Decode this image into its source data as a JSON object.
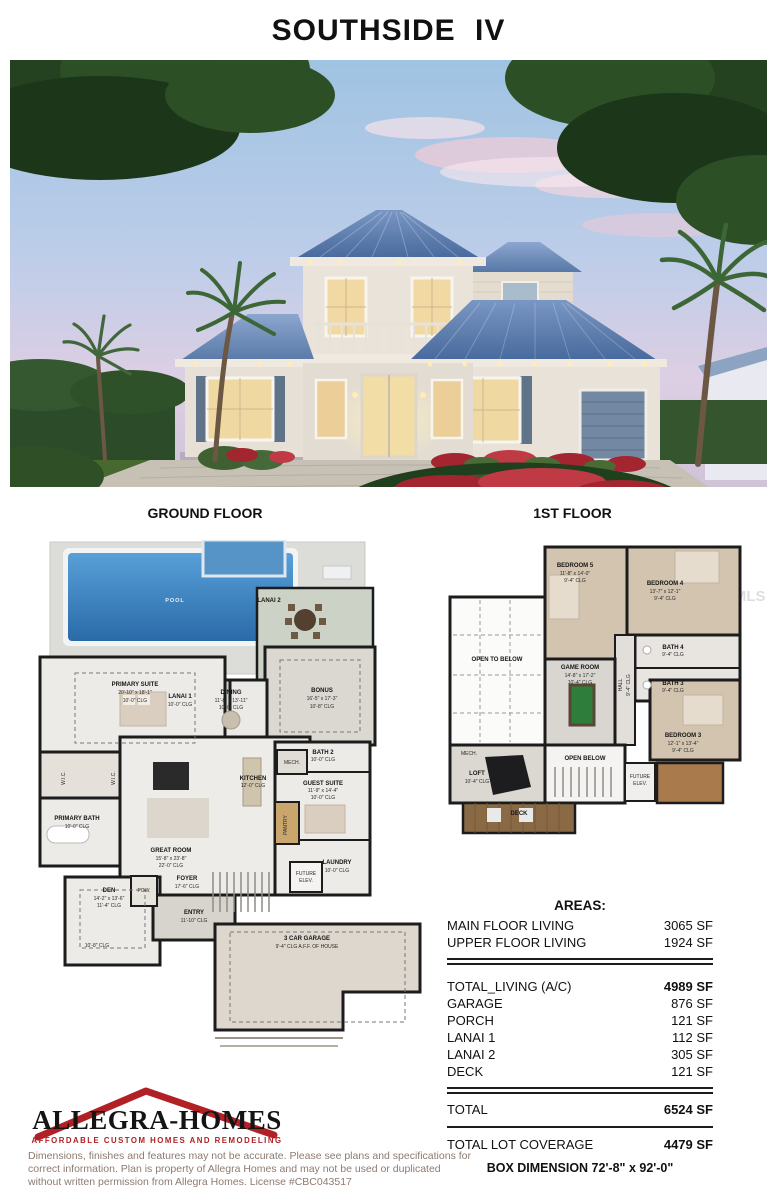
{
  "page": {
    "title": "SOUTHSIDE IV"
  },
  "floor_plans": {
    "ground": {
      "heading": "GROUND FLOOR",
      "rooms": [
        {
          "lines": [
            "POOL"
          ]
        },
        {
          "lines": [
            "LANAI 2"
          ]
        },
        {
          "lines": [
            "PRIMARY SUITE",
            "20'-10\" x 18'-1\"",
            "10'-0\" CLG"
          ]
        },
        {
          "lines": [
            "LANAI 1",
            "10'-0\" CLG"
          ]
        },
        {
          "lines": [
            "DINING",
            "11'-8\" x 13'-11\"",
            "10'-0\" CLG"
          ]
        },
        {
          "lines": [
            "BONUS",
            "16'-5\" x 17'-3\"",
            "10'-8\" CLG"
          ]
        },
        {
          "lines": [
            "BATH 2",
            "10'-0\" CLG"
          ]
        },
        {
          "lines": [
            "GUEST SUITE",
            "11'-9\" x 14'-4\"",
            "10'-0\" CLG"
          ]
        },
        {
          "lines": [
            "KITCHEN",
            "12'-0\" CLG"
          ]
        },
        {
          "lines": [
            "MECH."
          ]
        },
        {
          "lines": [
            "PANTRY"
          ]
        },
        {
          "lines": [
            "W.I.C."
          ]
        },
        {
          "lines": [
            "W.I.C."
          ]
        },
        {
          "lines": [
            "GREAT ROOM",
            "15'-8\" x 23'-8\"",
            "22'-0\" CLG"
          ]
        },
        {
          "lines": [
            "PRIMARY BATH",
            "10'-0\" CLG"
          ]
        },
        {
          "lines": [
            "FOYER",
            "17'-6\" CLG"
          ]
        },
        {
          "lines": [
            "POW."
          ]
        },
        {
          "lines": [
            "DEN",
            "14'-2\" x 13'-6\"",
            "11'-4\" CLG"
          ]
        },
        {
          "lines": [
            "10'-8\" CLG"
          ]
        },
        {
          "lines": [
            "LAUNDRY",
            "10'-0\" CLG"
          ]
        },
        {
          "lines": [
            "FUTURE",
            "ELEV."
          ]
        },
        {
          "lines": [
            "ENTRY",
            "11'-10\" CLG"
          ]
        },
        {
          "lines": [
            "3 CAR GARAGE",
            "9'-4\" CLG A.F.F. OF HOUSE"
          ]
        }
      ]
    },
    "first": {
      "heading": "1ST FLOOR",
      "rooms": [
        {
          "lines": [
            "BEDROOM 5",
            "11'-8\" x 14'-0\"",
            "9'-4\" CLG"
          ]
        },
        {
          "lines": [
            "BEDROOM 4",
            "13'-7\" x 12'-1\"",
            "9'-4\" CLG"
          ]
        },
        {
          "lines": [
            "BATH 4",
            "9'-4\" CLG"
          ]
        },
        {
          "lines": [
            "BATH 3",
            "9'-4\" CLG"
          ]
        },
        {
          "lines": [
            "GAME ROOM",
            "14'-8\" x 17'-2\"",
            "10'-4\" CLG"
          ]
        },
        {
          "lines": [
            "HALL",
            "9'-4\" CLG"
          ]
        },
        {
          "lines": [
            "OPEN TO BELOW"
          ]
        },
        {
          "lines": [
            "BEDROOM 3",
            "12'-1\" x 13'-4\"",
            "9'-4\" CLG"
          ]
        },
        {
          "lines": [
            "MECH."
          ]
        },
        {
          "lines": [
            "LOFT",
            "10'-4\" CLG"
          ]
        },
        {
          "lines": [
            "OPEN BELOW"
          ]
        },
        {
          "lines": [
            "FUTURE",
            "ELEV."
          ]
        },
        {
          "lines": [
            "DECK"
          ]
        }
      ]
    }
  },
  "watermark": "StellarMLS",
  "areas": {
    "heading": "AREAS:",
    "main_rows": [
      {
        "label": "MAIN FLOOR LIVING",
        "value": "3065 SF"
      },
      {
        "label": "UPPER FLOOR LIVING",
        "value": "1924 SF"
      }
    ],
    "detail_rows": [
      {
        "label": "TOTAL_LIVING (A/C)",
        "value": "4989 SF"
      },
      {
        "label": "GARAGE",
        "value": "876 SF"
      },
      {
        "label": "PORCH",
        "value": "121 SF"
      },
      {
        "label": "LANAI 1",
        "value": "112 SF"
      },
      {
        "label": "LANAI 2",
        "value": "305 SF"
      },
      {
        "label": "DECK",
        "value": "121 SF"
      }
    ],
    "total_row": {
      "label": "TOTAL",
      "value": "6524 SF"
    },
    "lot_row": {
      "label": "TOTAL LOT COVERAGE",
      "value": "4479 SF"
    },
    "box_dimension": "BOX DIMENSION 72'-8\" x 92'-0\""
  },
  "logo": {
    "name": "ALLEGRA-HOMES",
    "tagline": "AFFORDABLE CUSTOM HOMES AND REMODELING"
  },
  "disclaimer": "Dimensions, finishes and features may not be accurate. Please see plans and specifications for correct information. Plan is property of Allegra Homes and may not be used or duplicated without written permission from Allegra Homes. License #CBC043517",
  "colors": {
    "accent_red": "#b02025",
    "roof_blue": "#5b7fae",
    "pool_blue": "#3f7fbf",
    "shutter_slate": "#5f7389",
    "ink": "#1a1a1a",
    "disclaimer_text": "#8d7b70",
    "watermark_gray": "#d9d9d9"
  }
}
